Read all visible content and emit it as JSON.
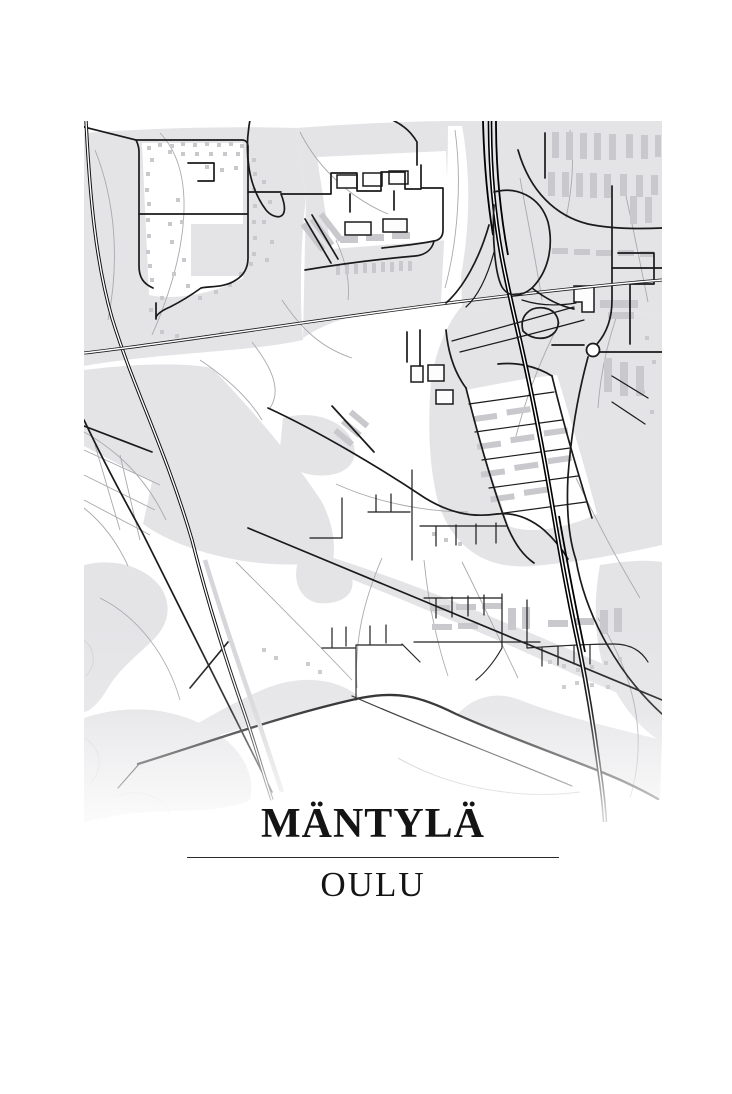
{
  "poster": {
    "title": "MÄNTYLÄ",
    "subtitle": "OULU"
  },
  "theme": {
    "colors": {
      "bg": "#ffffff",
      "land": "#e4e4e7",
      "building": "#c9c9cd",
      "path": "#a9a9ae",
      "road": "#1a1a1a",
      "rail": "#111111",
      "motorway": "#000000",
      "text": "#141414",
      "divider": "#2b2b2b"
    }
  }
}
